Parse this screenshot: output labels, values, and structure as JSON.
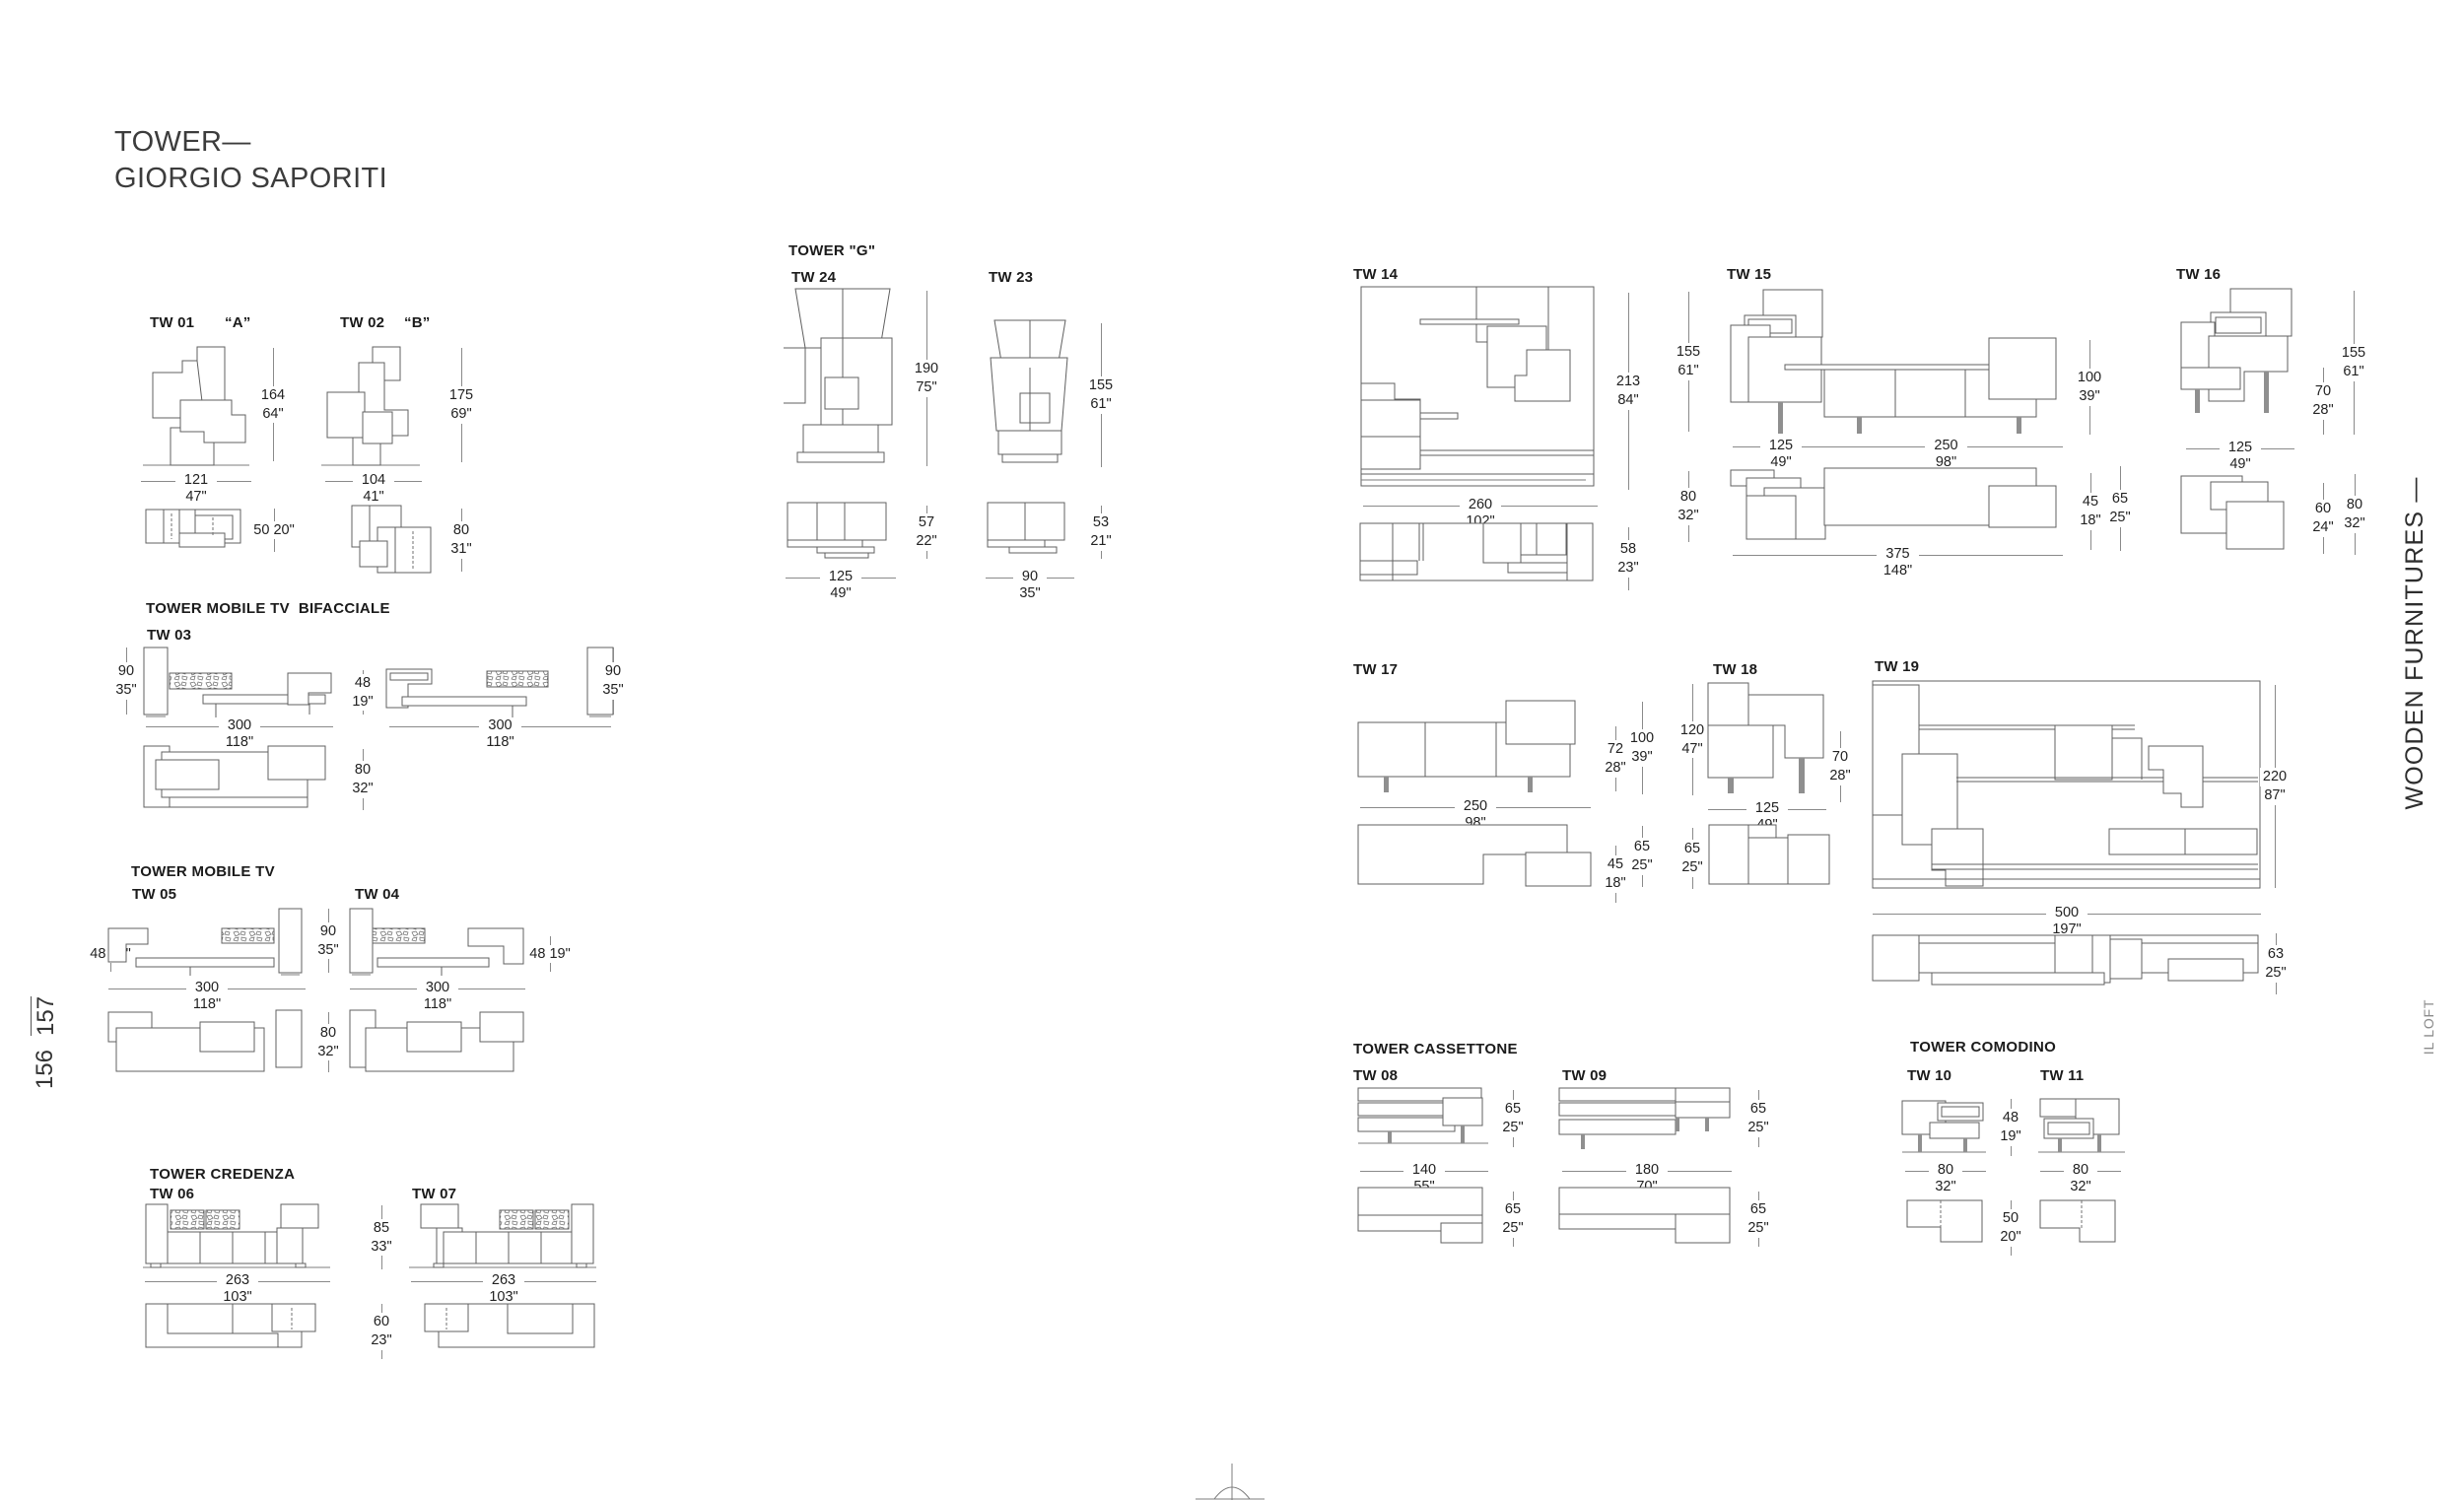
{
  "page": {
    "title_line1": "TOWER—",
    "title_line2": "GIORGIO SAPORITI",
    "page_no_left": "156",
    "page_no_right": "157",
    "side_text": "WOODEN FURNITURES —",
    "brand_side": "IL LOFT"
  },
  "colors": {
    "ink": "#1c1c1c",
    "drawing_line": "#606060",
    "dim_line": "#8a8a8a"
  },
  "headings": {
    "bifacciale": "TOWER MOBILE TV  BIFACCIALE",
    "mobiletv": "TOWER MOBILE TV",
    "credenza": "TOWER CREDENZA",
    "tower_g": "TOWER \"G\"",
    "cassettone": "TOWER CASSETTONE",
    "comodino": "TOWER COMODINO"
  },
  "models": {
    "tw01": {
      "label": "TW 01",
      "variant": "“A”",
      "h": {
        "cm": "164",
        "in": "64\""
      },
      "w": {
        "cm": "121",
        "in": "47\""
      },
      "plan": "50 20\""
    },
    "tw02": {
      "label": "TW 02",
      "variant": "“B”",
      "h": {
        "cm": "175",
        "in": "69\""
      },
      "w": {
        "cm": "104",
        "in": "41\""
      },
      "d": {
        "cm": "80",
        "in": "31\""
      }
    },
    "tw03": {
      "label": "TW 03",
      "h_side": {
        "cm": "90",
        "in": "35\""
      },
      "h_mid": {
        "cm": "48",
        "in": "19\""
      },
      "w": {
        "cm": "300",
        "in": "118\""
      },
      "plan_h": {
        "cm": "80",
        "in": "32\""
      }
    },
    "tw05": {
      "label": "TW 05",
      "side": "48 19\"",
      "w": {
        "cm": "300",
        "in": "118\""
      }
    },
    "tw04": {
      "label": "TW 04",
      "side": "48 19\"",
      "w": {
        "cm": "300",
        "in": "118\""
      }
    },
    "tw45": {
      "h": {
        "cm": "90",
        "in": "35\""
      },
      "plan": {
        "cm": "80",
        "in": "32\""
      }
    },
    "tw06": {
      "label": "TW 06",
      "w": {
        "cm": "263",
        "in": "103\""
      }
    },
    "tw07": {
      "label": "TW 07",
      "w": {
        "cm": "263",
        "in": "103\""
      }
    },
    "tw67": {
      "h": {
        "cm": "85",
        "in": "33\""
      },
      "plan": {
        "cm": "60",
        "in": "23\""
      }
    },
    "tw24": {
      "label": "TW 24",
      "h": {
        "cm": "190",
        "in": "75\""
      },
      "plan_d": {
        "cm": "57",
        "in": "22\""
      },
      "plan_w": {
        "cm": "125",
        "in": "49\""
      }
    },
    "tw23": {
      "label": "TW 23",
      "h": {
        "cm": "155",
        "in": "61\""
      },
      "plan_d": {
        "cm": "53",
        "in": "21\""
      },
      "plan_w": {
        "cm": "90",
        "in": "35\""
      }
    },
    "tw14": {
      "label": "TW 14",
      "h": {
        "cm": "213",
        "in": "84\""
      },
      "w": {
        "cm": "260",
        "in": "102\""
      },
      "d": {
        "cm": "58",
        "in": "23\""
      }
    },
    "tw15": {
      "label": "TW 15",
      "h1": {
        "cm": "155",
        "in": "61\""
      },
      "h2": {
        "cm": "100",
        "in": "39\""
      },
      "h3": {
        "cm": "80",
        "in": "32\""
      },
      "w1": {
        "cm": "125",
        "in": "49\""
      },
      "w2": {
        "cm": "250",
        "in": "98\""
      },
      "d1": {
        "cm": "45",
        "in": "18\""
      },
      "d2": {
        "cm": "65",
        "in": "25\""
      },
      "total": {
        "cm": "375",
        "in": "148\""
      }
    },
    "tw16": {
      "label": "TW 16",
      "h": {
        "cm": "155",
        "in": "61\""
      },
      "h2": {
        "cm": "70",
        "in": "28\""
      },
      "w": {
        "cm": "125",
        "in": "49\""
      },
      "d": {
        "cm": "60",
        "in": "24\""
      },
      "d2": {
        "cm": "80",
        "in": "32\""
      }
    },
    "tw17": {
      "label": "TW 17",
      "h1": {
        "cm": "72",
        "in": "28\""
      },
      "h2": {
        "cm": "100",
        "in": "39\""
      },
      "w": {
        "cm": "250",
        "in": "98\""
      },
      "d1": {
        "cm": "45",
        "in": "18\""
      },
      "d2": {
        "cm": "65",
        "in": "25\""
      }
    },
    "tw18": {
      "label": "TW 18",
      "h": {
        "cm": "120",
        "in": "47\""
      },
      "h2": {
        "cm": "70",
        "in": "28\""
      },
      "w": {
        "cm": "125",
        "in": "49\""
      },
      "d": {
        "cm": "65",
        "in": "25\""
      }
    },
    "tw19": {
      "label": "TW 19",
      "h": {
        "cm": "220",
        "in": "87\""
      },
      "w": {
        "cm": "500",
        "in": "197\""
      },
      "d": {
        "cm": "63",
        "in": "25\""
      }
    },
    "tw08": {
      "label": "TW 08",
      "h": {
        "cm": "65",
        "in": "25\""
      },
      "w": {
        "cm": "140",
        "in": "55\""
      },
      "d": {
        "cm": "65",
        "in": "25\""
      }
    },
    "tw09": {
      "label": "TW 09",
      "h": {
        "cm": "65",
        "in": "25\""
      },
      "w": {
        "cm": "180",
        "in": "70\""
      },
      "d": {
        "cm": "65",
        "in": "25\""
      }
    },
    "tw10": {
      "label": "TW 10",
      "w": {
        "cm": "80",
        "in": "32\""
      }
    },
    "tw11": {
      "label": "TW 11",
      "w": {
        "cm": "80",
        "in": "32\""
      }
    },
    "tw1011": {
      "h": {
        "cm": "48",
        "in": "19\""
      },
      "plan": {
        "cm": "50",
        "in": "20\""
      }
    }
  }
}
